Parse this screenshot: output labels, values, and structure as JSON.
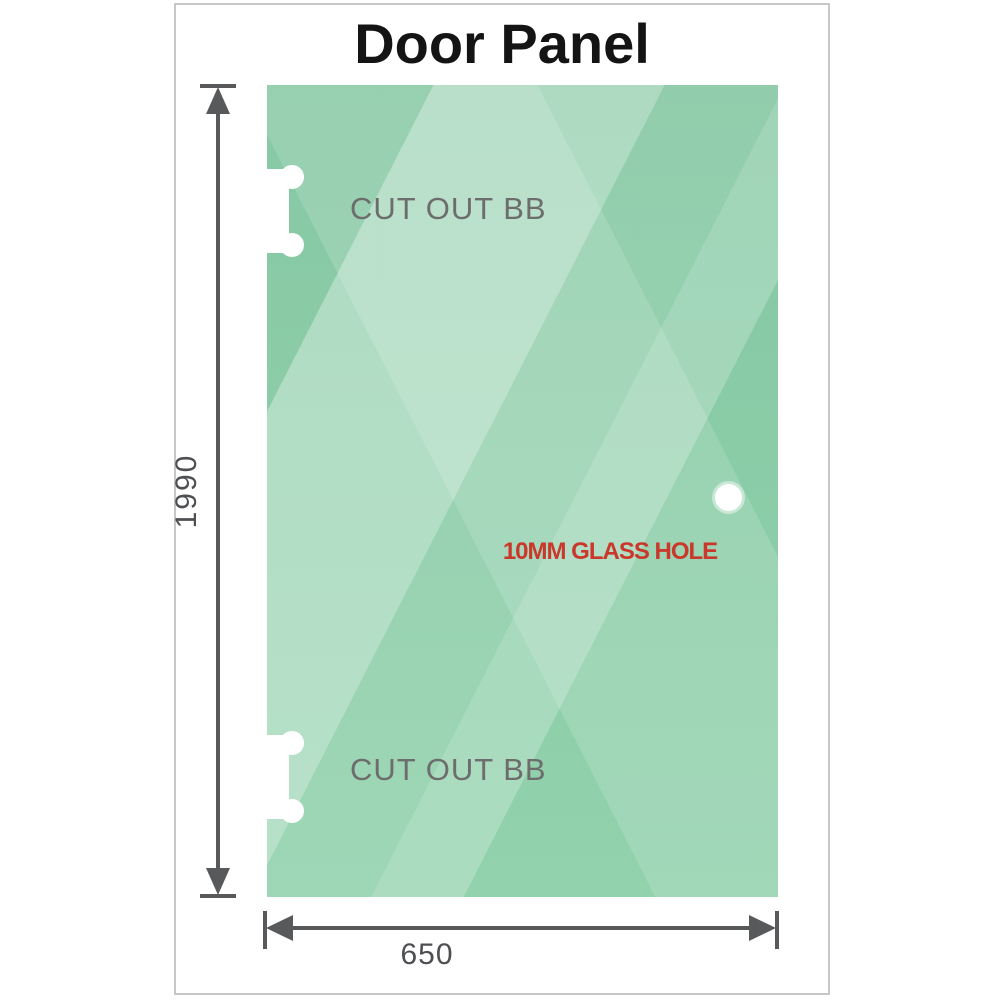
{
  "title": "Door Panel",
  "colors": {
    "glass_green": "#7cc49c",
    "glass_highlight": "#c3e8d2",
    "dimension_gray": "#58595b",
    "cutout_label_gray": "#6d6d6d",
    "hole_label_red": "#c9382a",
    "frame_border": "#c6c7c9"
  },
  "panel": {
    "cutout_top_label": "CUT OUT BB",
    "cutout_bottom_label": "CUT OUT BB",
    "hole_label": "10MM GLASS HOLE"
  },
  "dimensions": {
    "height": "1990",
    "width": "650"
  }
}
